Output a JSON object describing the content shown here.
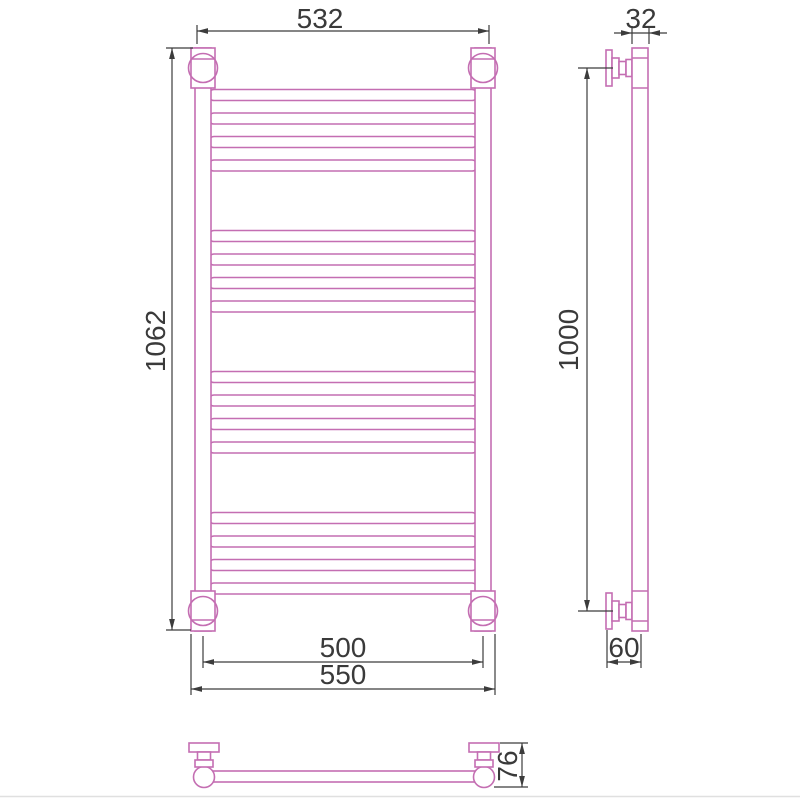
{
  "colors": {
    "part_outline": "#c46eb2",
    "dimension_line": "#3c3c3c",
    "label_text": "#3a3a3a",
    "background": "#ffffff"
  },
  "front_view": {
    "rung_groups": 4,
    "rungs_per_group": 4,
    "dimensions": {
      "top_mount_width": "532",
      "overall_height": "1062",
      "tube_axis_spacing": "500",
      "overall_width": "550"
    }
  },
  "side_view": {
    "dimensions": {
      "tube_diameter": "32",
      "bracket_vertical_spacing": "1000",
      "wall_to_axis_offset": "60"
    }
  },
  "plan_view": {
    "dimensions": {
      "wall_to_front_depth": "76"
    }
  }
}
